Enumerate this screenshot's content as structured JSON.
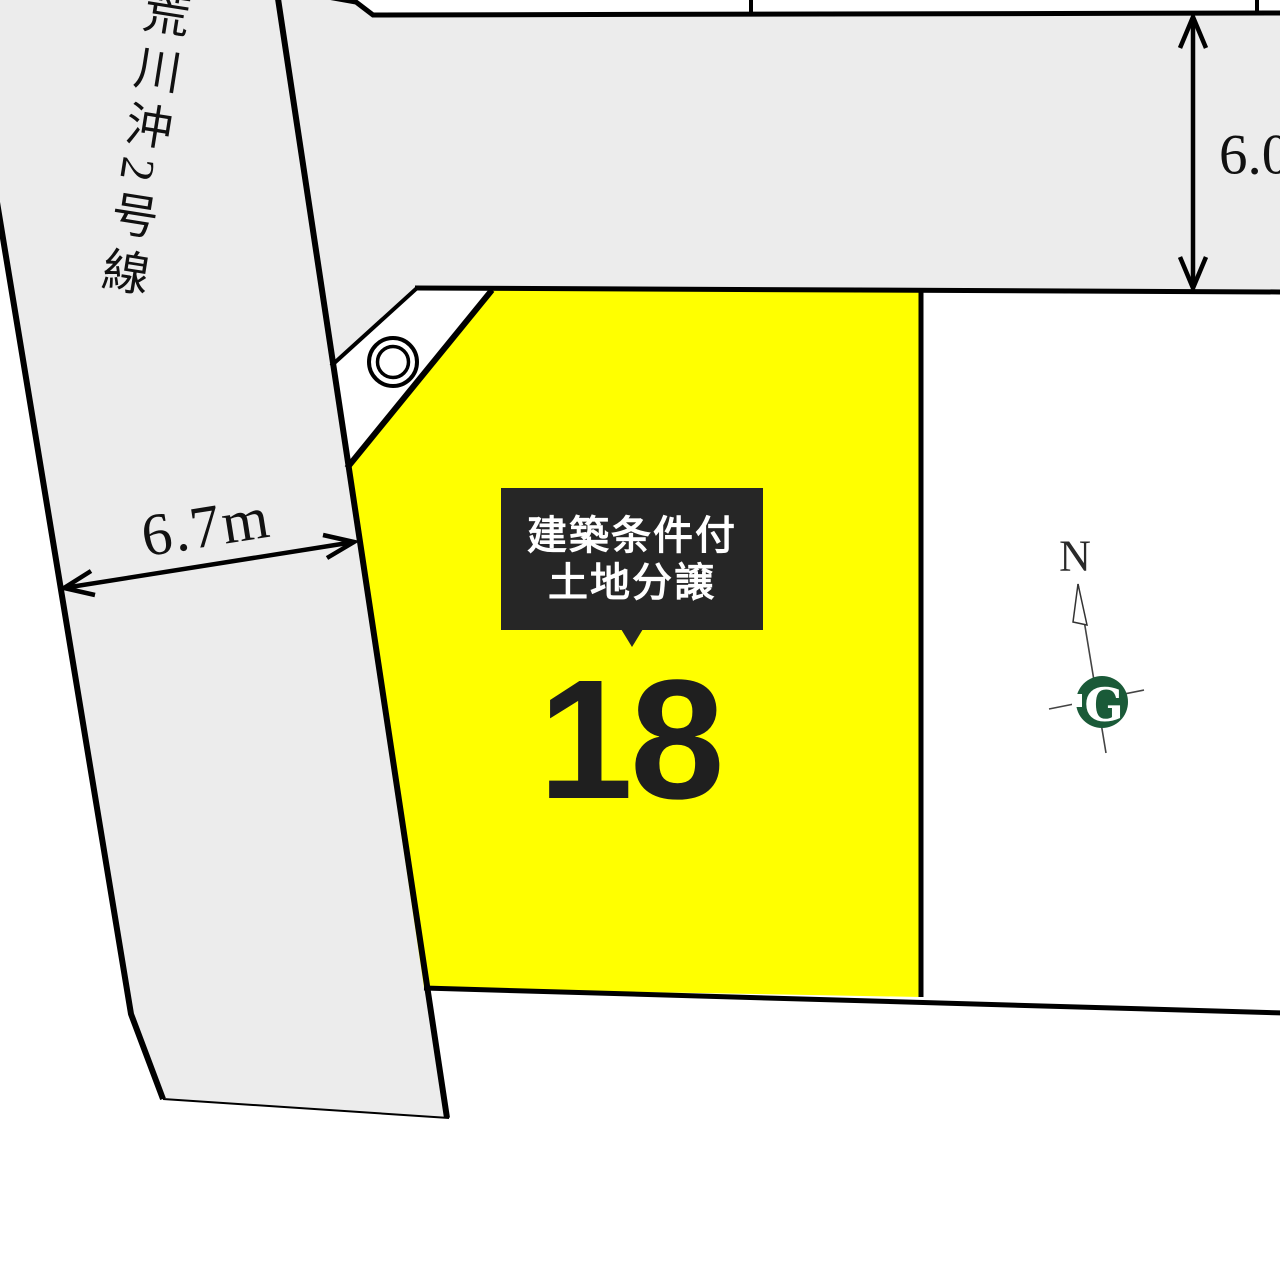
{
  "map": {
    "roads": {
      "vertical_road_name": "荒川沖2号線",
      "vertical_road_width": "6.7m",
      "horizontal_road_width": "6.0m"
    },
    "lot": {
      "number": "18",
      "badge": {
        "line1": "建築条件付",
        "line2": "土地分譲"
      }
    },
    "compass": {
      "north_label": "N",
      "logo_letter": "G"
    },
    "colors": {
      "lot_fill": "#ffff00",
      "road_fill": "#ececec",
      "line": "#000000",
      "badge_bg": "#262626",
      "badge_text": "#ffffff",
      "lot_number_color": "#1f1f1f",
      "logo_green": "#1a5a38"
    }
  }
}
